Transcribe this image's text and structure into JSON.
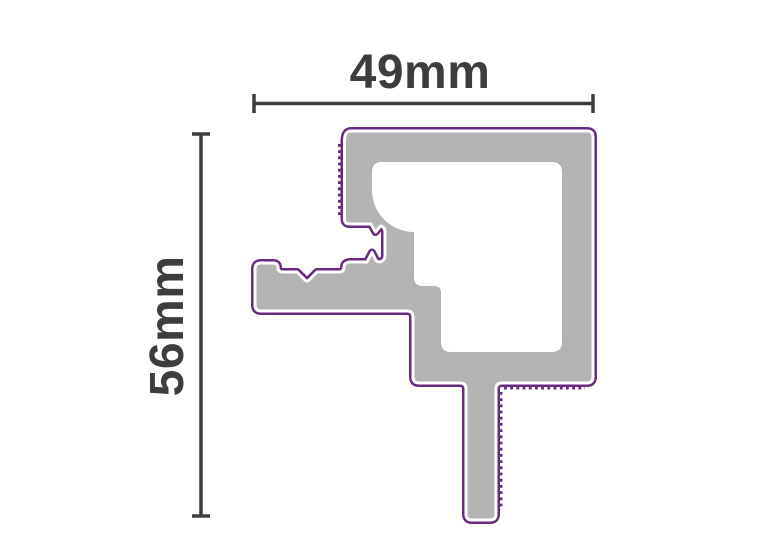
{
  "diagram": {
    "width_label": "49mm",
    "height_label": "56mm",
    "colors": {
      "profile_fill": "#b3b3b3",
      "profile_outline": "#682a80",
      "chamber_fill": "#ffffff",
      "dimension_lines": "#3d3d3f",
      "background": "#ffffff"
    }
  }
}
